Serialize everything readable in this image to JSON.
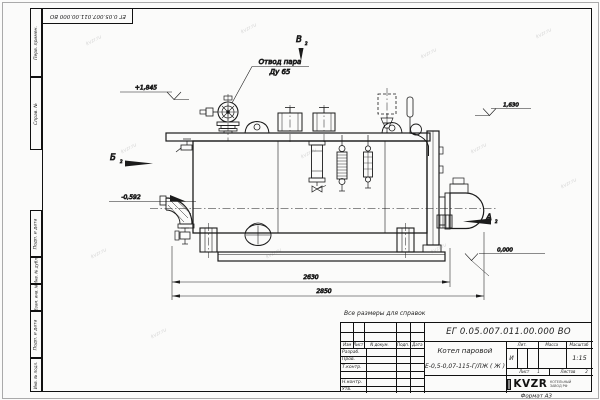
{
  "sheet": {
    "format_note": "Формат А3",
    "reference_note": "Все размеры для справок",
    "watermark": "kvzr.ru"
  },
  "corner_stamp": {
    "doc_number": "ЕГ 0.05.007.011.00.000  ВО"
  },
  "margin_columns": [
    "Перв. примен.",
    "Справ. №",
    "Подп. и дата",
    "Инв. № дубл.",
    "Взам. инв. №",
    "Подп. и дата",
    "Инв. № подл."
  ],
  "drawing": {
    "callout": {
      "line1": "Отвод пара",
      "line2": "Ду 65"
    },
    "view_markers": {
      "b": "Б",
      "v": "В",
      "a": "А",
      "sheet_ref": "2"
    },
    "elevations": {
      "valve_top": "+1,845",
      "rear_top": "1,630",
      "feed_inlet": "-0,592",
      "ground": "0,000"
    },
    "dimensions": {
      "shell_length": "2630",
      "overall_length": "2850"
    }
  },
  "title_block": {
    "doc_number": "ЕГ 0.05.007.011.00.000  ВО",
    "product_line1": "Котел паровой",
    "product_line2": "Е-0,5-0,07-115-Г/ЛЖ ( Ж )",
    "rev_cols": {
      "izm": "Изм",
      "list": "Лист",
      "doc": "N докум.",
      "sign": "Подп.",
      "date": "Дата"
    },
    "roles": {
      "r1": "Разраб.",
      "r2": "Пров.",
      "r3": "Т.контр.",
      "r5": "Н.контр.",
      "r6": "Утв."
    },
    "props": {
      "lit": "Лит.",
      "mass": "Масса",
      "scale": "Масштаб",
      "lit_value": "И",
      "scale_value": "1:15"
    },
    "sheets": {
      "sheet_label": "Лист",
      "sheet_no": "1",
      "sheets_label": "Листов",
      "sheets_no": "2"
    },
    "logo": {
      "name": "KVZR",
      "sub1": "КОТЕЛЬНЫЙ",
      "sub2": "ЗАВОД РФ"
    }
  }
}
